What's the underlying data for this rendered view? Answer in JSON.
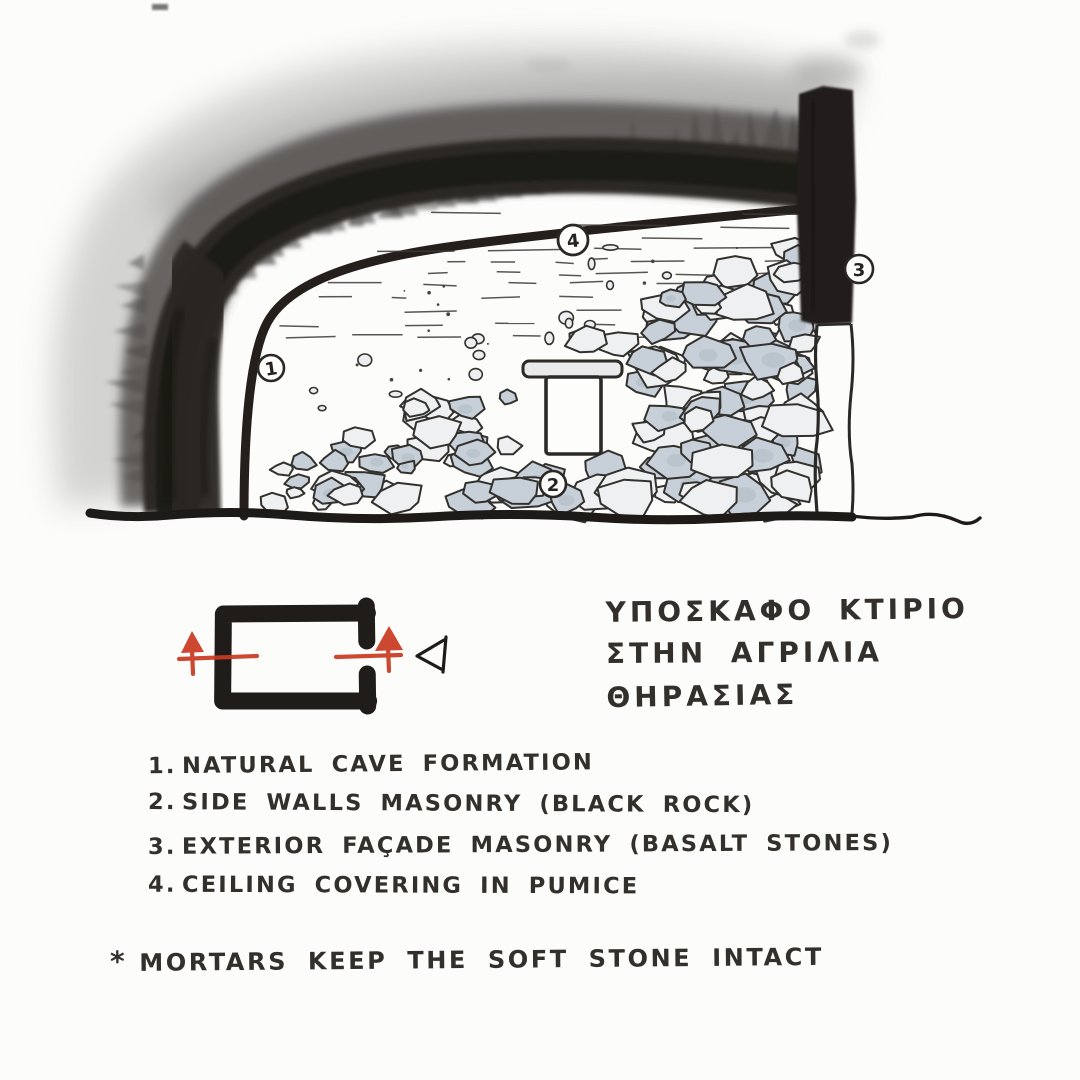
{
  "colors": {
    "paper": "#fcfcfa",
    "ink": "#33302c",
    "charcoal": "#2c2623",
    "red_section_marker": "#c93b22",
    "stone_fill": "#eef0f1",
    "stone_shade": "#c7d0d8"
  },
  "sketch": {
    "callouts": [
      {
        "num": "1",
        "meaning": "NATURAL CAVE FORMATION"
      },
      {
        "num": "2",
        "meaning": "SIDE WALLS MASONRY (BLACK ROCK)"
      },
      {
        "num": "3",
        "meaning": "EXTERIOR FAÇADE MASONRY (BASALT STONES)"
      },
      {
        "num": "4",
        "meaning": "CEILING COVERING IN PUMICE"
      }
    ]
  },
  "title": {
    "lines": [
      "ΥΠΟΣΚΑΦΟ ΚΤΙΡΙΟ",
      "ΣΤΗΝ ΑΓΡΙΛΙΑ",
      "ΘΗΡΑΣΙΑΣ"
    ]
  },
  "legend": {
    "items": [
      {
        "num": "1.",
        "text": "NATURAL CAVE FORMATION"
      },
      {
        "num": "2.",
        "text": "SIDE WALLS MASONRY (BLACK ROCK)"
      },
      {
        "num": "3.",
        "text": "EXTERIOR FAÇADE MASONRY (BASALT STONES)"
      },
      {
        "num": "4.",
        "text": "CEILING COVERING IN PUMICE"
      }
    ]
  },
  "footnote": {
    "marker": "*",
    "text": "MORTARS KEEP THE SOFT STONE INTACT"
  }
}
